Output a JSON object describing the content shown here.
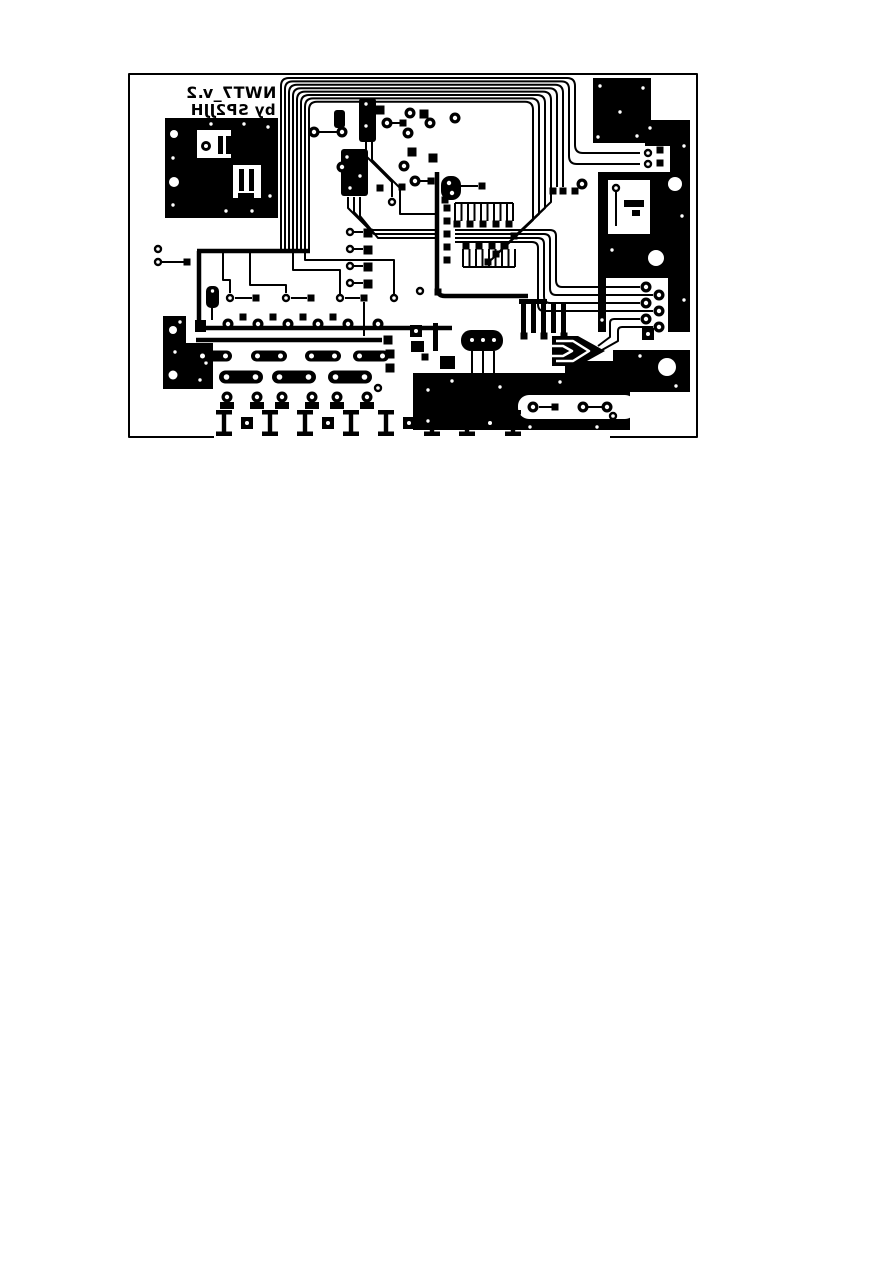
{
  "page": {
    "background_color": "#ffffff"
  },
  "pcb": {
    "board_color": "#ffffff",
    "copper_color": "#000000",
    "silkscreen": {
      "line1": "NWT7_v.2",
      "line2": "by SP2JJH",
      "mirrored": true
    }
  }
}
